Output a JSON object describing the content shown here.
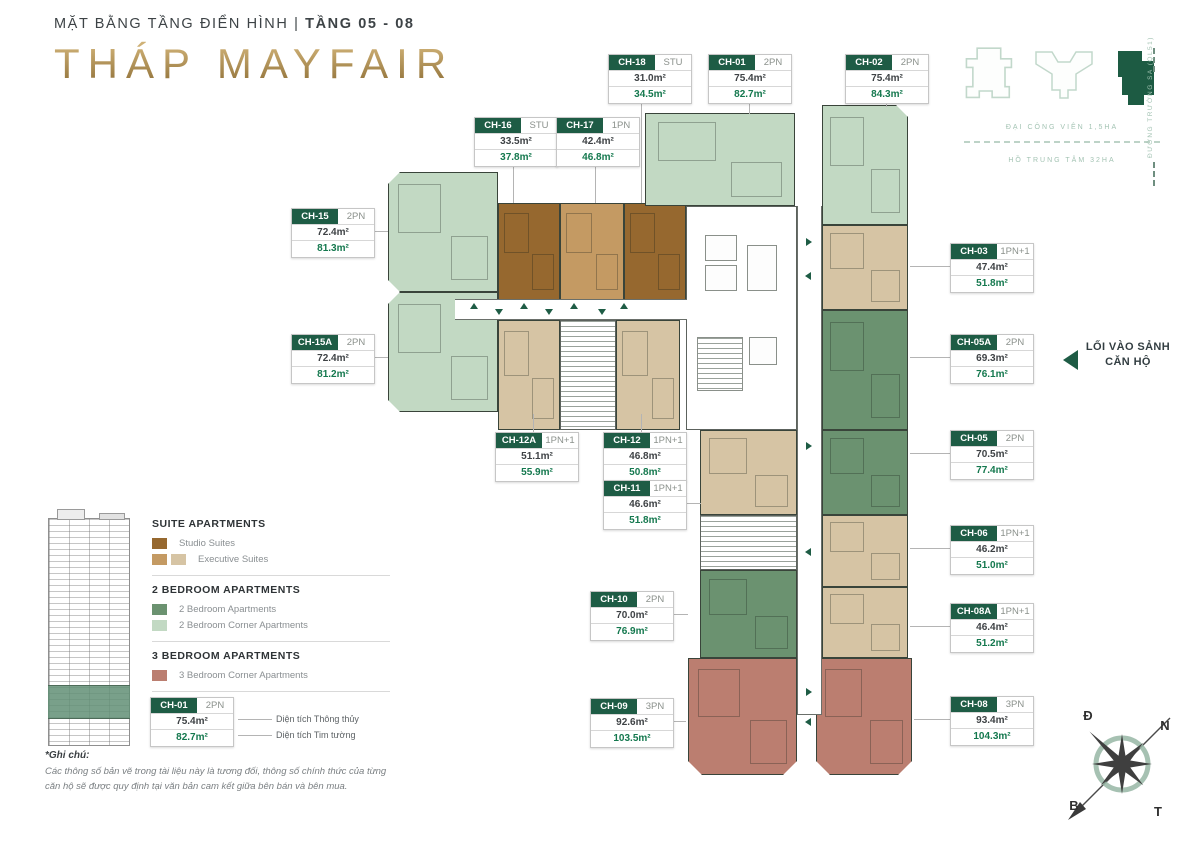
{
  "header": {
    "plan_label": "MẶT BẰNG TẦNG ĐIỂN HÌNH",
    "separator": "|",
    "floors_label": "TẦNG 05 - 08",
    "tower_title": "THÁP MAYFAIR"
  },
  "minimap": {
    "park": "ĐẠI CÔNG VIÊN 1,5HA",
    "lake": "HỒ TRUNG TÂM 32HA",
    "road": "ĐƯỜNG TRƯỜNG SA (QL51)"
  },
  "entrance": {
    "line1": "LỐI VÀO SẢNH",
    "line2": "CĂN HỘ"
  },
  "compass": {
    "top_left": "Đ",
    "top_right": "N",
    "bottom_left": "B",
    "bottom_right": "T"
  },
  "colors": {
    "accent_green": "#1e5c45",
    "area_value_green": "#14784e",
    "gold": "#b99a5b",
    "studio": "#96682f",
    "exec1": "#c49a63",
    "exec2": "#d6c4a4",
    "two_bed": "#6b9270",
    "two_bed_corner": "#c2d9c3",
    "three_bed": "#bb7e70"
  },
  "legend": {
    "sections": [
      {
        "title": "SUITE APARTMENTS",
        "items": [
          {
            "label": "Studio Suites",
            "swatches": [
              "#96682f"
            ]
          },
          {
            "label": "Executive Suites",
            "swatches": [
              "#c49a63",
              "#d6c4a4"
            ]
          }
        ]
      },
      {
        "title": "2 BEDROOM APARTMENTS",
        "items": [
          {
            "label": "2 Bedroom Apartments",
            "swatches": [
              "#6b9270"
            ]
          },
          {
            "label": "2 Bedroom Corner Apartments",
            "swatches": [
              "#c2d9c3"
            ]
          }
        ]
      },
      {
        "title": "3 BEDROOM APARTMENTS",
        "items": [
          {
            "label": "3 Bedroom Corner Apartments",
            "swatches": [
              "#bb7e70"
            ]
          }
        ]
      }
    ]
  },
  "sample": {
    "id": "CH-01",
    "type": "2PN",
    "net": "75.4m²",
    "gross": "82.7m²",
    "net_note": "Diện tích Thông thủy",
    "gross_note": "Diện tích Tim tường"
  },
  "note": {
    "title": "*Ghi chú:",
    "text": "Các thông số bản vẽ trong tài liệu này là tương đối, thông số chính thức của từng căn hộ sẽ được quy định tại văn bản cam kết giữa bên bán và bên mua."
  },
  "units": [
    {
      "id": "CH-18",
      "type": "STU",
      "net": "31.0m²",
      "gross": "34.5m²",
      "cat": "studio"
    },
    {
      "id": "CH-01",
      "type": "2PN",
      "net": "75.4m²",
      "gross": "82.7m²",
      "cat": "two_bed_corner"
    },
    {
      "id": "CH-02",
      "type": "2PN",
      "net": "75.4m²",
      "gross": "84.3m²",
      "cat": "two_bed_corner"
    },
    {
      "id": "CH-16",
      "type": "STU",
      "net": "33.5m²",
      "gross": "37.8m²",
      "cat": "studio"
    },
    {
      "id": "CH-17",
      "type": "1PN",
      "net": "42.4m²",
      "gross": "46.8m²",
      "cat": "exec1"
    },
    {
      "id": "CH-15",
      "type": "2PN",
      "net": "72.4m²",
      "gross": "81.3m²",
      "cat": "two_bed_corner"
    },
    {
      "id": "CH-15A",
      "type": "2PN",
      "net": "72.4m²",
      "gross": "81.2m²",
      "cat": "two_bed_corner"
    },
    {
      "id": "CH-03",
      "type": "1PN+1",
      "net": "47.4m²",
      "gross": "51.8m²",
      "cat": "exec2"
    },
    {
      "id": "CH-05A",
      "type": "2PN",
      "net": "69.3m²",
      "gross": "76.1m²",
      "cat": "two_bed"
    },
    {
      "id": "CH-05",
      "type": "2PN",
      "net": "70.5m²",
      "gross": "77.4m²",
      "cat": "two_bed"
    },
    {
      "id": "CH-06",
      "type": "1PN+1",
      "net": "46.2m²",
      "gross": "51.0m²",
      "cat": "exec2"
    },
    {
      "id": "CH-08A",
      "type": "1PN+1",
      "net": "46.4m²",
      "gross": "51.2m²",
      "cat": "exec2"
    },
    {
      "id": "CH-08",
      "type": "3PN",
      "net": "93.4m²",
      "gross": "104.3m²",
      "cat": "three_bed"
    },
    {
      "id": "CH-12A",
      "type": "1PN+1",
      "net": "51.1m²",
      "gross": "55.9m²",
      "cat": "exec2"
    },
    {
      "id": "CH-12",
      "type": "1PN+1",
      "net": "46.8m²",
      "gross": "50.8m²",
      "cat": "exec2"
    },
    {
      "id": "CH-11",
      "type": "1PN+1",
      "net": "46.6m²",
      "gross": "51.8m²",
      "cat": "exec2"
    },
    {
      "id": "CH-10",
      "type": "2PN",
      "net": "70.0m²",
      "gross": "76.9m²",
      "cat": "two_bed"
    },
    {
      "id": "CH-09",
      "type": "3PN",
      "net": "92.6m²",
      "gross": "103.5m²",
      "cat": "three_bed"
    }
  ]
}
